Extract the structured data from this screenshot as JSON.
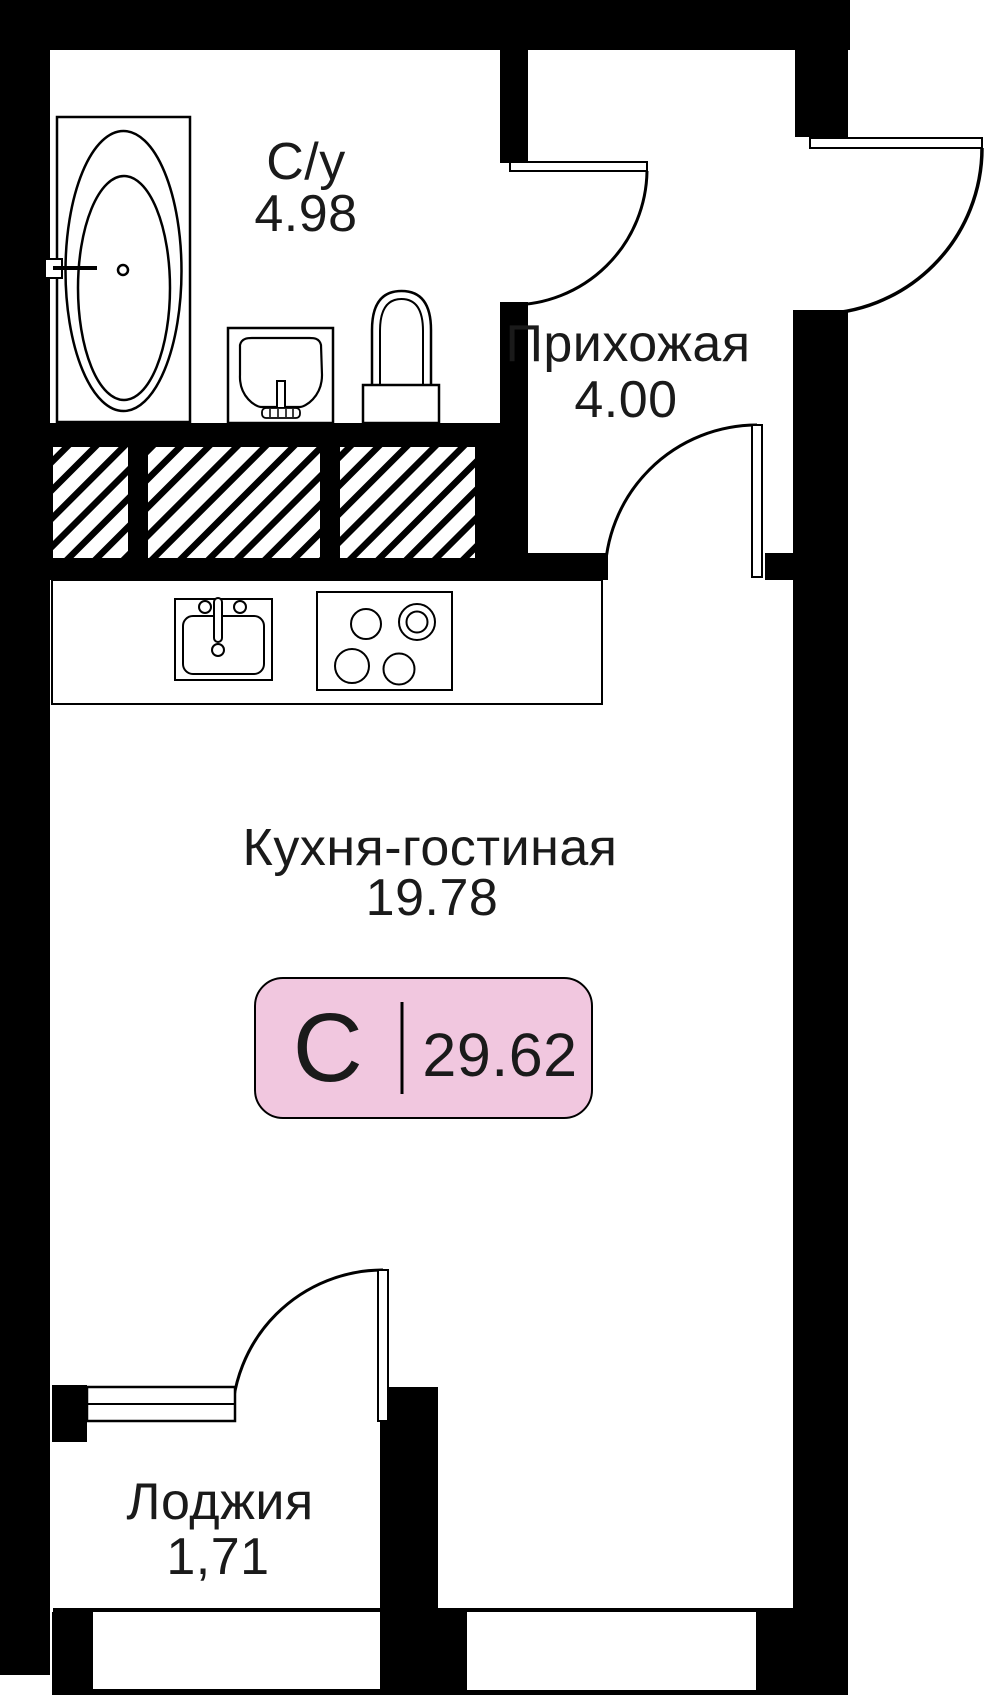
{
  "plan": {
    "rooms": {
      "bathroom": {
        "label": "С/у",
        "area": "4.98"
      },
      "hallway": {
        "label": "Прихожая",
        "area": "4.00"
      },
      "kitchen_living": {
        "label": "Кухня-гостиная",
        "area": "19.78"
      },
      "loggia": {
        "label": "Лоджия",
        "area": "1,71"
      }
    },
    "badge": {
      "type_letter": "С",
      "total_area": "29.62"
    },
    "colors": {
      "wall": "#000000",
      "text": "#1a1a1a",
      "badge_bg": "#F1C7DF",
      "badge_border": "#000000",
      "background": "#ffffff"
    },
    "icons": [
      "bathtub-icon",
      "washbasin-icon",
      "toilet-icon",
      "kitchen-sink-icon",
      "stove-icon",
      "door-swing-icon",
      "window-icon",
      "vent-shaft-hatch-icon"
    ]
  }
}
